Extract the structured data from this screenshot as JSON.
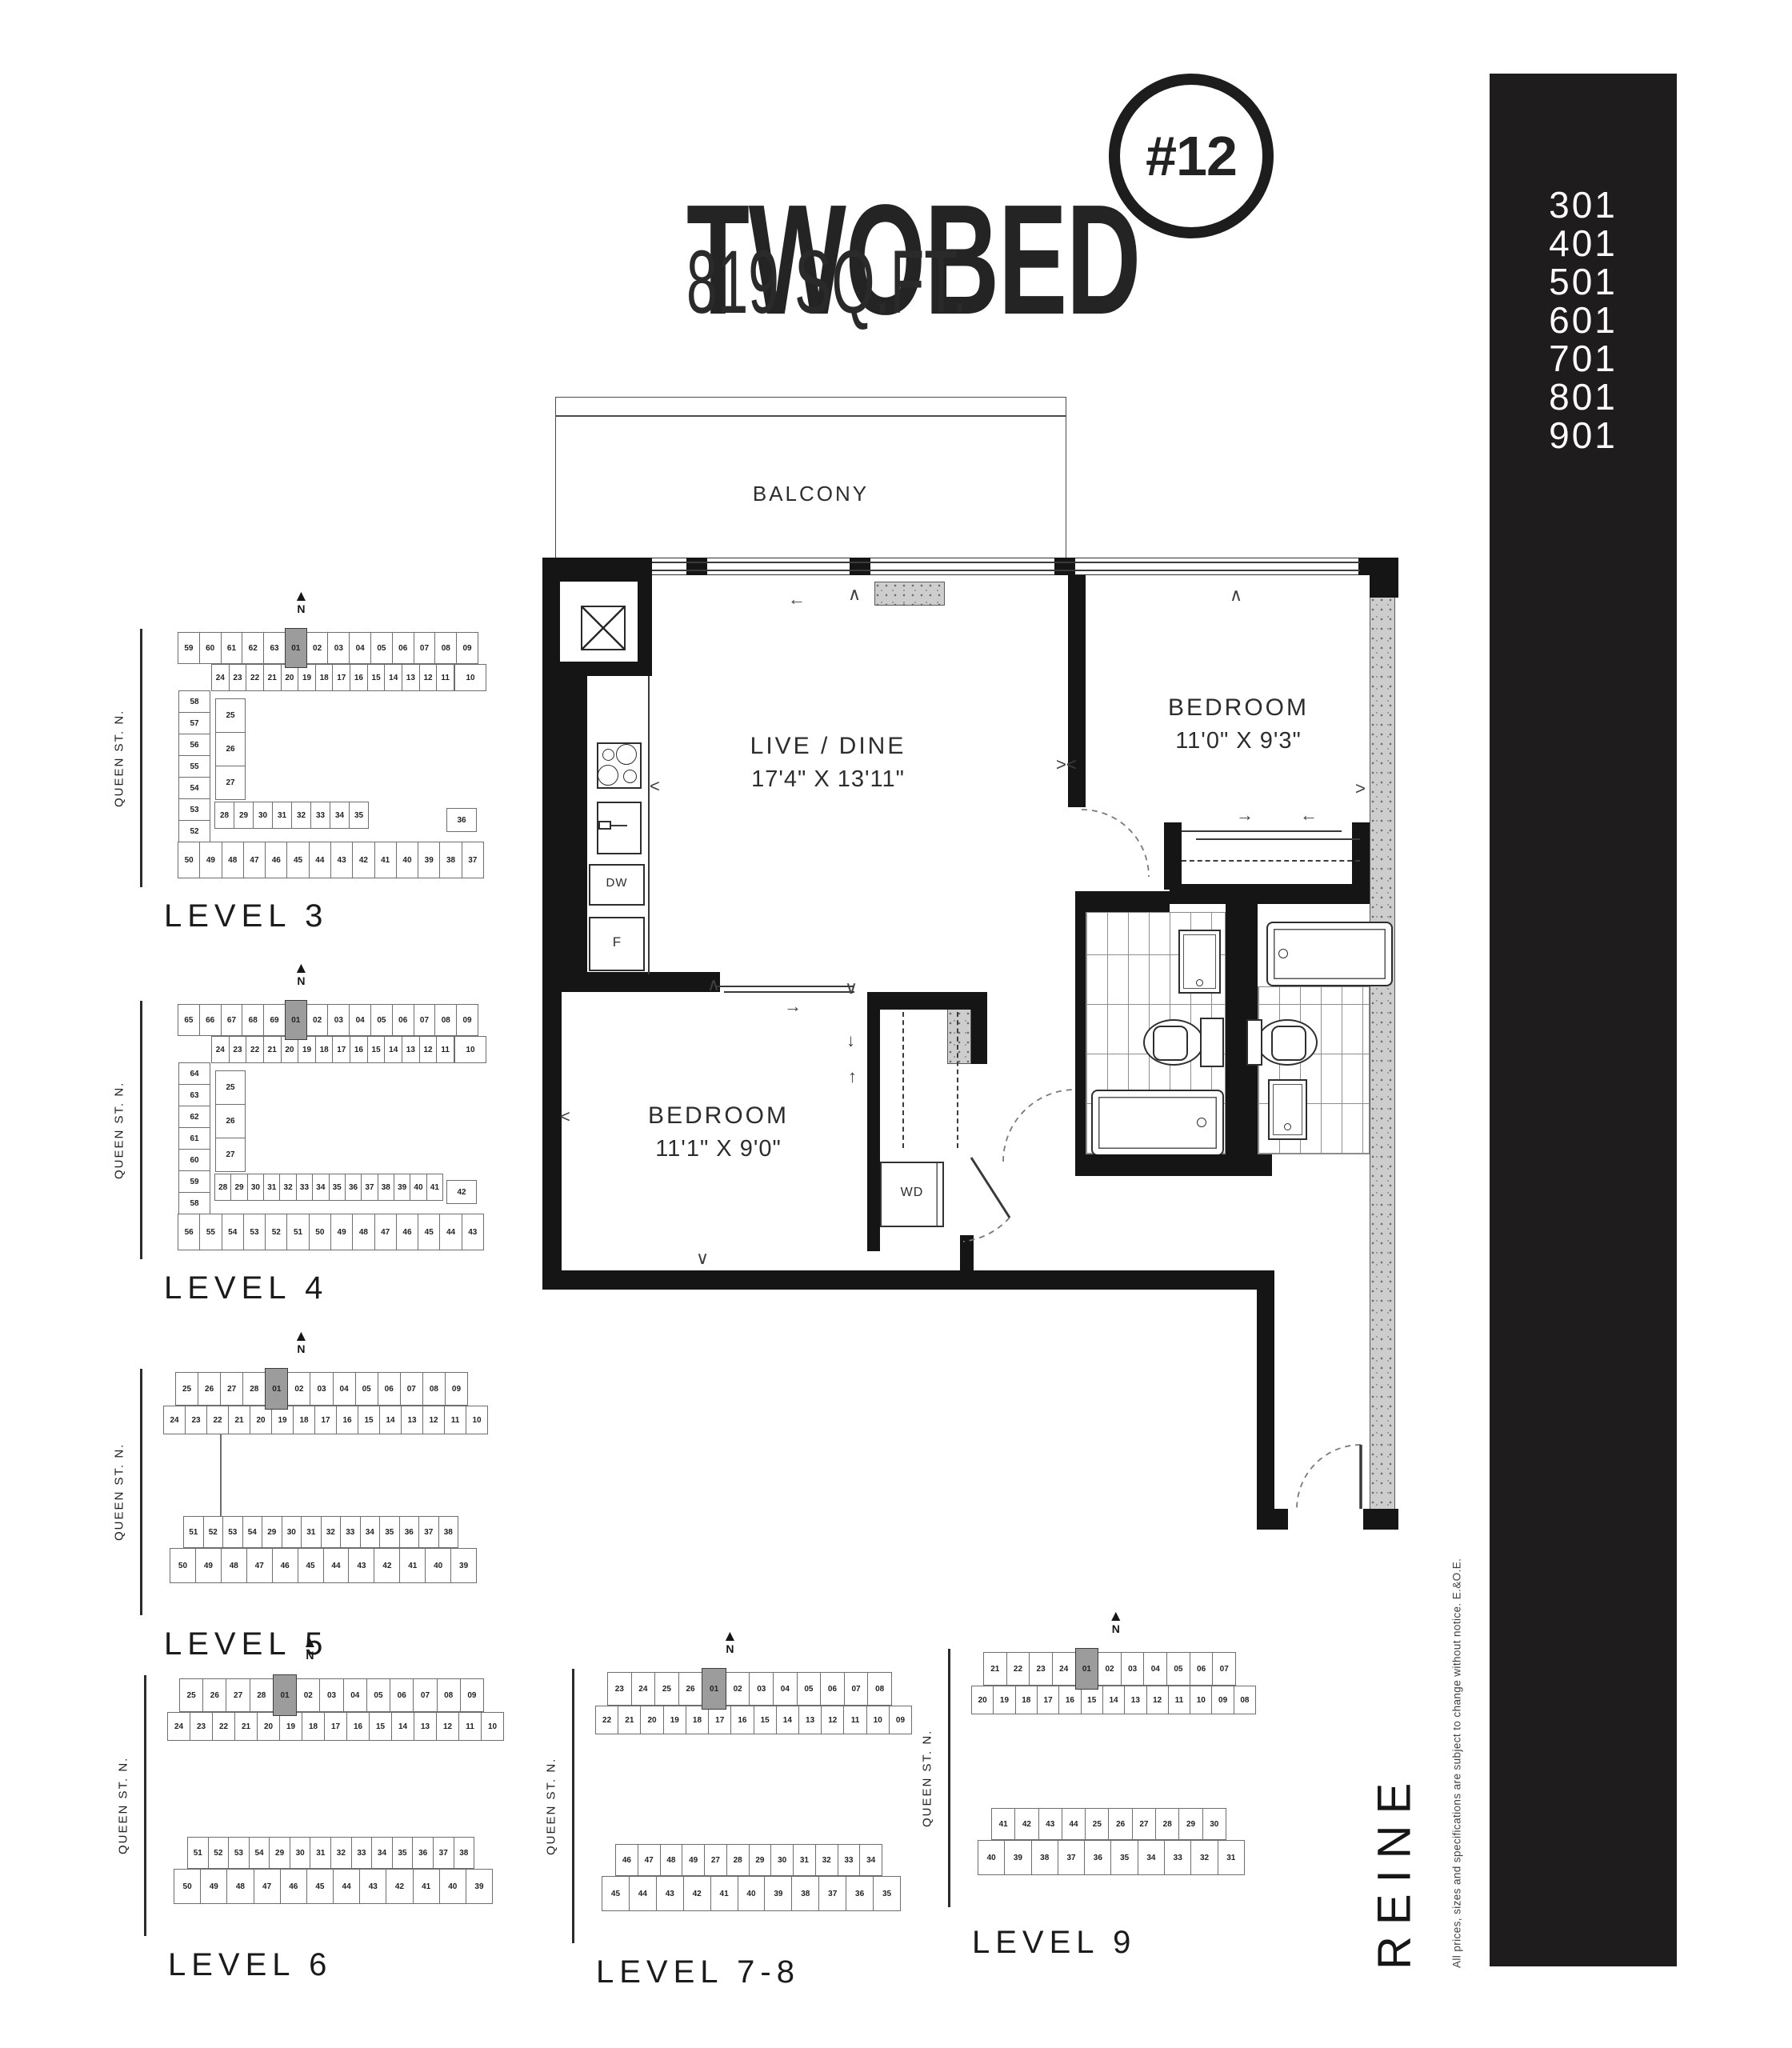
{
  "title": {
    "name": "TWOBED",
    "badge": "#12",
    "area": "819 SQ.FT."
  },
  "sidebar": {
    "bg_color": "#1e1c1c",
    "text_color": "#ffffff",
    "units": [
      "301",
      "401",
      "501",
      "601",
      "701",
      "801",
      "901"
    ]
  },
  "branding": {
    "logo": "REINE",
    "disclaimer": "All prices, sizes and specifications are subject to change without notice. E.&O.E."
  },
  "misc": {
    "north_label": "N"
  },
  "floorplan": {
    "balcony": "BALCONY",
    "live_dine": {
      "name": "LIVE / DINE",
      "dims": "17'4\" X 13'11\""
    },
    "bedroom_primary": {
      "name": "BEDROOM",
      "dims": "11'0\" X 9'3\""
    },
    "bedroom_second": {
      "name": "BEDROOM",
      "dims": "11'1\" X 9'0\""
    },
    "appliances": {
      "dishwasher": "DW",
      "fridge": "F",
      "washer_dryer": "WD"
    },
    "highlight_color": "#9c9c9c",
    "wall_color": "#151515"
  },
  "keyplans": [
    {
      "id": "l3",
      "label": "LEVEL 3",
      "street": "QUEEN ST. N.",
      "type": "c",
      "highlight": "01",
      "cells": {
        "topOuter": [
          "59",
          "60",
          "61",
          "62",
          "63",
          "01",
          "02",
          "03",
          "04",
          "05",
          "06",
          "07",
          "08",
          "09"
        ],
        "topInner": [
          "24",
          "23",
          "22",
          "21",
          "20",
          "19",
          "18",
          "17",
          "16",
          "15",
          "14",
          "13",
          "12",
          "11"
        ],
        "rightTop": "10",
        "leftCol": [
          "58",
          "57",
          "56",
          "55",
          "54",
          "53",
          "52",
          "51"
        ],
        "midCol": [
          "25",
          "26",
          "27"
        ],
        "innerBottom": [
          "28",
          "29",
          "30",
          "31",
          "32",
          "33",
          "34",
          "35"
        ],
        "rightSingle": "36",
        "bottomOuter": [
          "50",
          "49",
          "48",
          "47",
          "46",
          "45",
          "44",
          "43",
          "42",
          "41",
          "40",
          "39",
          "38",
          "37"
        ]
      }
    },
    {
      "id": "l4",
      "label": "LEVEL 4",
      "street": "QUEEN ST. N.",
      "type": "c",
      "highlight": "01",
      "cells": {
        "topOuter": [
          "65",
          "66",
          "67",
          "68",
          "69",
          "01",
          "02",
          "03",
          "04",
          "05",
          "06",
          "07",
          "08",
          "09"
        ],
        "topInner": [
          "24",
          "23",
          "22",
          "21",
          "20",
          "19",
          "18",
          "17",
          "16",
          "15",
          "14",
          "13",
          "12",
          "11"
        ],
        "rightTop": "10",
        "leftCol": [
          "64",
          "63",
          "62",
          "61",
          "60",
          "59",
          "58",
          "57"
        ],
        "midCol": [
          "25",
          "26",
          "27"
        ],
        "innerBottom": [
          "28",
          "29",
          "30",
          "31",
          "32",
          "33",
          "34",
          "35",
          "36",
          "37",
          "38",
          "39",
          "40",
          "41"
        ],
        "rightSingle": "42",
        "bottomOuter": [
          "56",
          "55",
          "54",
          "53",
          "52",
          "51",
          "50",
          "49",
          "48",
          "47",
          "46",
          "45",
          "44",
          "43"
        ]
      }
    },
    {
      "id": "l5",
      "label": "LEVEL 5",
      "street": "QUEEN ST. N.",
      "type": "bars",
      "connector": true,
      "highlight": "01",
      "cells": {
        "bar1a": [
          "25",
          "26",
          "27",
          "28",
          "01",
          "02",
          "03",
          "04",
          "05",
          "06",
          "07",
          "08",
          "09"
        ],
        "bar1b": [
          "24",
          "23",
          "22",
          "21",
          "20",
          "19",
          "18",
          "17",
          "16",
          "15",
          "14",
          "13",
          "12",
          "11",
          "10"
        ],
        "bar2a": [
          "51",
          "52",
          "53",
          "54",
          "29",
          "30",
          "31",
          "32",
          "33",
          "34",
          "35",
          "36",
          "37",
          "38"
        ],
        "bar2b": [
          "50",
          "49",
          "48",
          "47",
          "46",
          "45",
          "44",
          "43",
          "42",
          "41",
          "40",
          "39"
        ]
      }
    },
    {
      "id": "l6",
      "label": "LEVEL 6",
      "street": "QUEEN ST. N.",
      "type": "bars",
      "connector": false,
      "highlight": "01",
      "cells": {
        "bar1a": [
          "25",
          "26",
          "27",
          "28",
          "01",
          "02",
          "03",
          "04",
          "05",
          "06",
          "07",
          "08",
          "09"
        ],
        "bar1b": [
          "24",
          "23",
          "22",
          "21",
          "20",
          "19",
          "18",
          "17",
          "16",
          "15",
          "14",
          "13",
          "12",
          "11",
          "10"
        ],
        "bar2a": [
          "51",
          "52",
          "53",
          "54",
          "29",
          "30",
          "31",
          "32",
          "33",
          "34",
          "35",
          "36",
          "37",
          "38"
        ],
        "bar2b": [
          "50",
          "49",
          "48",
          "47",
          "46",
          "45",
          "44",
          "43",
          "42",
          "41",
          "40",
          "39"
        ]
      }
    },
    {
      "id": "l78",
      "label": "LEVEL 7-8",
      "street": "QUEEN ST. N.",
      "type": "bars",
      "connector": false,
      "highlight": "01",
      "cells": {
        "bar1a": [
          "23",
          "24",
          "25",
          "26",
          "01",
          "02",
          "03",
          "04",
          "05",
          "06",
          "07",
          "08"
        ],
        "bar1b": [
          "22",
          "21",
          "20",
          "19",
          "18",
          "17",
          "16",
          "15",
          "14",
          "13",
          "12",
          "11",
          "10",
          "09"
        ],
        "bar2a": [
          "46",
          "47",
          "48",
          "49",
          "27",
          "28",
          "29",
          "30",
          "31",
          "32",
          "33",
          "34"
        ],
        "bar2b": [
          "45",
          "44",
          "43",
          "42",
          "41",
          "40",
          "39",
          "38",
          "37",
          "36",
          "35"
        ]
      }
    },
    {
      "id": "l9",
      "label": "LEVEL 9",
      "street": "QUEEN ST. N.",
      "type": "bars",
      "connector": false,
      "highlight": "01",
      "cells": {
        "bar1a": [
          "21",
          "22",
          "23",
          "24",
          "01",
          "02",
          "03",
          "04",
          "05",
          "06",
          "07"
        ],
        "bar1b": [
          "20",
          "19",
          "18",
          "17",
          "16",
          "15",
          "14",
          "13",
          "12",
          "11",
          "10",
          "09",
          "08"
        ],
        "bar2a": [
          "41",
          "42",
          "43",
          "44",
          "25",
          "26",
          "27",
          "28",
          "29",
          "30"
        ],
        "bar2b": [
          "40",
          "39",
          "38",
          "37",
          "36",
          "35",
          "34",
          "33",
          "32",
          "31"
        ]
      }
    }
  ]
}
